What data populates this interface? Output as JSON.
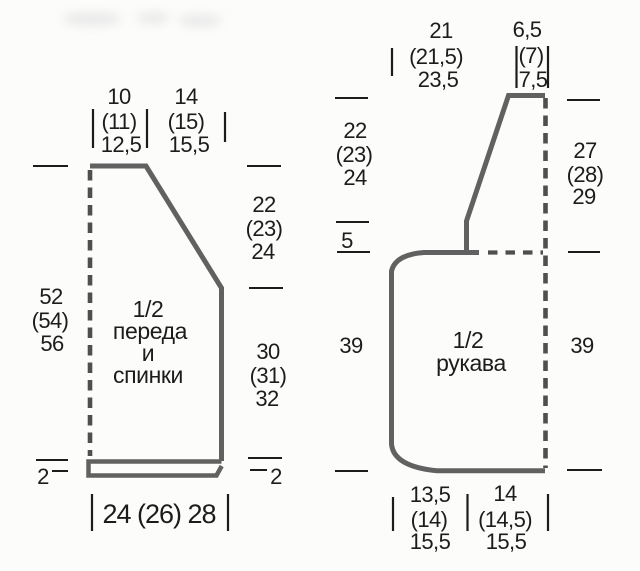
{
  "diagram": {
    "kind": "knitting pattern schematic, measurements in cm",
    "colors": {
      "outline_gray": "#616161",
      "dash_gray": "#4f4f4f",
      "ink_black": "#1c1c1c",
      "paper": "#fcfcfb"
    }
  },
  "front_back": {
    "label": [
      "1/2",
      "переда",
      "и",
      "спинки"
    ],
    "top_width_a": [
      "10",
      "(11)",
      "12,5"
    ],
    "top_width_b": [
      "14",
      "(15)",
      "15,5"
    ],
    "right_upper": [
      "22",
      "(23)",
      "24"
    ],
    "left_side": [
      "52",
      "(54)",
      "56"
    ],
    "right_lower": [
      "30",
      "(31)",
      "32"
    ],
    "hem_left": "2",
    "hem_right": "2",
    "bottom_width": "24 (26) 28"
  },
  "sleeve": {
    "label": [
      "1/2",
      "рукава"
    ],
    "top_width": [
      "21",
      "(21,5)",
      "23,5"
    ],
    "top_cap_width": [
      "6,5",
      "(7)",
      "7,5"
    ],
    "left_upper": [
      "22",
      "(23)",
      "24"
    ],
    "left_small": "5",
    "left_lower": "39",
    "right_upper": [
      "27",
      "(28)",
      "29"
    ],
    "right_lower": "39",
    "bottom_width_a": [
      "13,5",
      "(14)",
      "15,5"
    ],
    "bottom_width_b": [
      "14",
      "(14,5)",
      "15,5"
    ]
  }
}
